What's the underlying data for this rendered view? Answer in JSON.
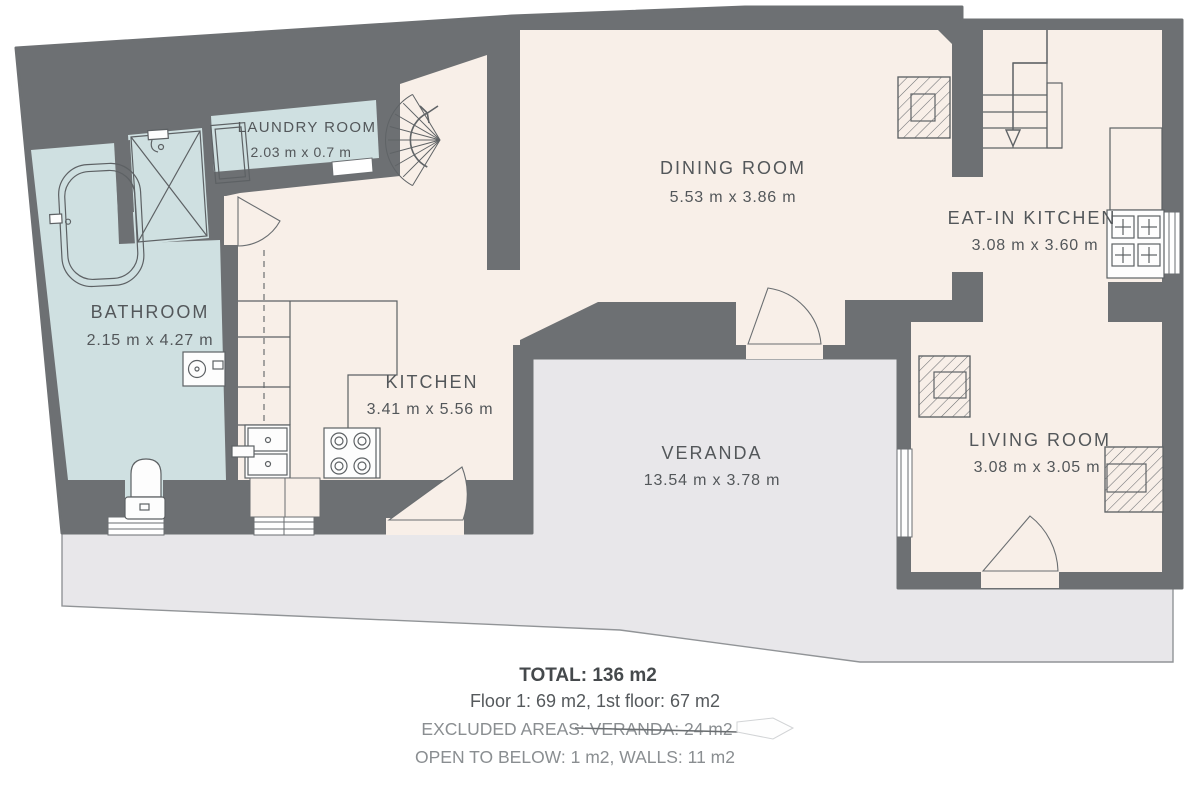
{
  "plan": {
    "rooms": [
      {
        "id": "laundry",
        "name": "LAUNDRY ROOM",
        "dims": "2.03 m x 0.7 m"
      },
      {
        "id": "bathroom",
        "name": "BATHROOM",
        "dims": "2.15 m x 4.27 m"
      },
      {
        "id": "kitchen",
        "name": "KITCHEN",
        "dims": "3.41 m x 5.56 m"
      },
      {
        "id": "dining",
        "name": "DINING ROOM",
        "dims": "5.53 m x 3.86 m"
      },
      {
        "id": "eatin",
        "name": "EAT-IN KITCHEN",
        "dims": "3.08 m x 3.60 m"
      },
      {
        "id": "living",
        "name": "LIVING ROOM",
        "dims": "3.08 m x 3.05 m"
      },
      {
        "id": "veranda",
        "name": "VERANDA",
        "dims": "13.54 m x 3.78 m"
      }
    ],
    "summary": {
      "total": "TOTAL: 136 m2",
      "floors": "Floor 1: 69 m2, 1st floor: 67 m2",
      "excluded_prefix": "EXCLUDED AREAS: ",
      "excluded_value": "VERANDA: 24 m2",
      "open_walls": "OPEN TO BELOW: 1 m2,  WALLS: 11 m2"
    },
    "colors": {
      "wall": "#6d7073",
      "room_cream": "#f8efe8",
      "room_blue": "#cfe0e1",
      "veranda_gray": "#e8e7ea",
      "fixture_line": "#5d6164",
      "white": "#ffffff"
    }
  }
}
